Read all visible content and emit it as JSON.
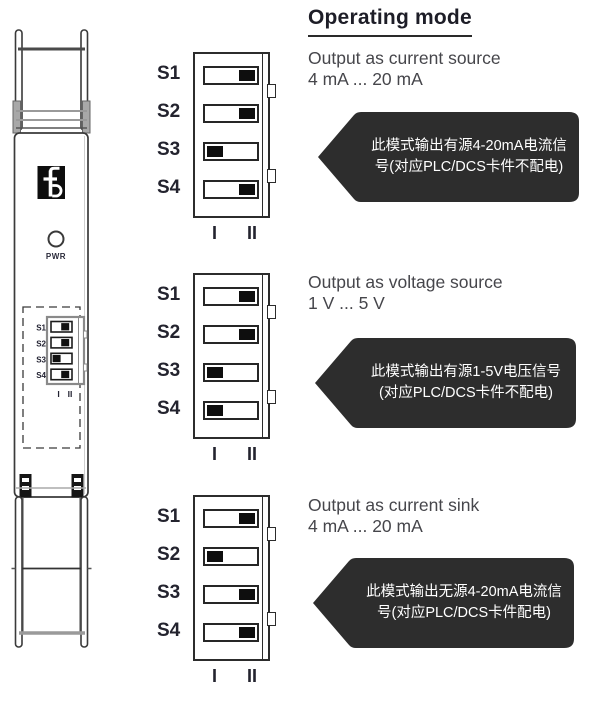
{
  "header": {
    "title": "Operating mode"
  },
  "device": {
    "description": "isolator module front view",
    "pwr_label": "PWR",
    "switch_labels": [
      "S1",
      "S2",
      "S3",
      "S4"
    ],
    "position_labels": [
      "I",
      "II"
    ],
    "mini_dip": {
      "positions": [
        "II",
        "II",
        "I",
        "II"
      ]
    }
  },
  "dip": {
    "position_labels": [
      "I",
      "II"
    ]
  },
  "modes": [
    {
      "title": "Output as current source",
      "range": "4 mA ... 20 mA",
      "switches": [
        {
          "label": "S1",
          "position": "II"
        },
        {
          "label": "S2",
          "position": "II"
        },
        {
          "label": "S3",
          "position": "I"
        },
        {
          "label": "S4",
          "position": "II"
        }
      ],
      "note": "此模式输出有源4-20mA电流信号(对应PLC/DCS卡件不配电)"
    },
    {
      "title": "Output as voltage source",
      "range": "1 V ... 5 V",
      "switches": [
        {
          "label": "S1",
          "position": "II"
        },
        {
          "label": "S2",
          "position": "II"
        },
        {
          "label": "S3",
          "position": "I"
        },
        {
          "label": "S4",
          "position": "I"
        }
      ],
      "note": "此模式输出有源1-5V电压信号(对应PLC/DCS卡件不配电)"
    },
    {
      "title": "Output as current sink",
      "range": "4 mA ... 20 mA",
      "switches": [
        {
          "label": "S1",
          "position": "II"
        },
        {
          "label": "S2",
          "position": "I"
        },
        {
          "label": "S3",
          "position": "II"
        },
        {
          "label": "S4",
          "position": "II"
        }
      ],
      "note": "此模式输出无源4-20mA电流信号(对应PLC/DCS卡件配电)"
    }
  ],
  "colors": {
    "callout_bg": "#2d2d2d",
    "callout_text": "#ffffff",
    "heading_text": "#1d1d27",
    "body_text": "#46464b",
    "line": "#2c2c2c"
  }
}
